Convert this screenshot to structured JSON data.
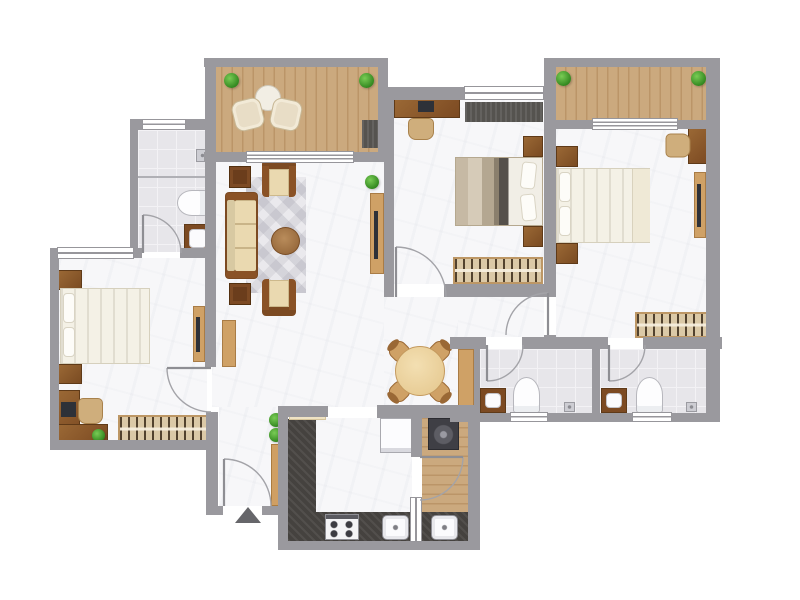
{
  "colors": {
    "wall": "#9a999e",
    "floor": "#f7f7f9",
    "tile": "#e7e6ea",
    "tileLine": "#f3f2f5",
    "frame": "#97969b",
    "deck": "#cba97e",
    "deckLine": "#bb9568",
    "woodDark": "#7c4a22",
    "woodMid": "#9a6835",
    "woodTan": "#cfa166",
    "cream": "#ead9b0",
    "bedLinen": "#f4f1e6",
    "tvBlack": "#2e3138",
    "counter": "#45423f",
    "green": "#3fa32c",
    "arc": "#a3a3a8",
    "marker": "#66666a"
  },
  "plan": {
    "type": "apartment-floor-plan-top-view",
    "entrance": {
      "marker": "triangle-arrow-up",
      "door": "single-swing"
    },
    "rooms": [
      {
        "name": "balcony-top-left",
        "floor": "wood-deck",
        "items": [
          "potted-plant",
          "potted-plant",
          "lounge-chair",
          "lounge-chair",
          "round-tea-table",
          "floor-mat"
        ]
      },
      {
        "name": "living-room",
        "floor": "marble",
        "items": [
          "three-seat-sofa",
          "armchair",
          "armchair",
          "side-table",
          "side-table",
          "round-coffee-table",
          "area-rug",
          "tv-console",
          "tv",
          "potted-plant",
          "tall-cabinet"
        ]
      },
      {
        "name": "ensuite-bathroom-top-left",
        "floor": "tile",
        "items": [
          "toilet",
          "wash-basin",
          "shower-divider",
          "floor-drain",
          "window"
        ]
      },
      {
        "name": "bedroom-left",
        "floor": "marble",
        "items": [
          "double-bed",
          "nightstand",
          "nightstand",
          "tv-console",
          "tv",
          "corner-desk",
          "monitor",
          "desk-chair",
          "potted-plant",
          "wardrobe",
          "window",
          "door"
        ]
      },
      {
        "name": "bedroom-middle",
        "floor": "marble",
        "items": [
          "double-bed",
          "nightstand",
          "nightstand",
          "desk",
          "monitor",
          "desk-chair",
          "window-mat",
          "wardrobe",
          "window",
          "door"
        ]
      },
      {
        "name": "balcony-top-right",
        "floor": "wood-deck",
        "items": [
          "potted-plant",
          "potted-plant",
          "sliding-door"
        ]
      },
      {
        "name": "bedroom-right",
        "floor": "marble",
        "items": [
          "double-bed",
          "nightstand",
          "nightstand",
          "desk",
          "desk-chair",
          "tv-console",
          "tv",
          "wardrobe",
          "sliding-door",
          "door"
        ]
      },
      {
        "name": "corridor",
        "floor": "marble",
        "items": []
      },
      {
        "name": "common-bathroom",
        "floor": "tile",
        "items": [
          "toilet",
          "wash-basin",
          "floor-drain",
          "window",
          "door"
        ]
      },
      {
        "name": "ensuite-bathroom-right",
        "floor": "tile",
        "items": [
          "toilet",
          "wash-basin",
          "floor-drain",
          "window",
          "door"
        ]
      },
      {
        "name": "dining-area",
        "floor": "marble",
        "items": [
          "round-dining-table",
          "dining-chair",
          "dining-chair",
          "dining-chair",
          "dining-chair",
          "tall-cabinet"
        ]
      },
      {
        "name": "kitchen",
        "floor": "marble",
        "items": [
          "l-shaped-counter",
          "gas-hob",
          "kitchen-sink",
          "refrigerator",
          "prep-bench",
          "window"
        ]
      },
      {
        "name": "utility-balcony",
        "floor": "wood-deck",
        "items": [
          "washing-machine",
          "utility-sink",
          "door",
          "window"
        ]
      },
      {
        "name": "foyer",
        "floor": "marble",
        "items": [
          "entrance-door",
          "shoe-cabinet",
          "potted-plant",
          "potted-plant",
          "entry-marker"
        ]
      }
    ]
  }
}
